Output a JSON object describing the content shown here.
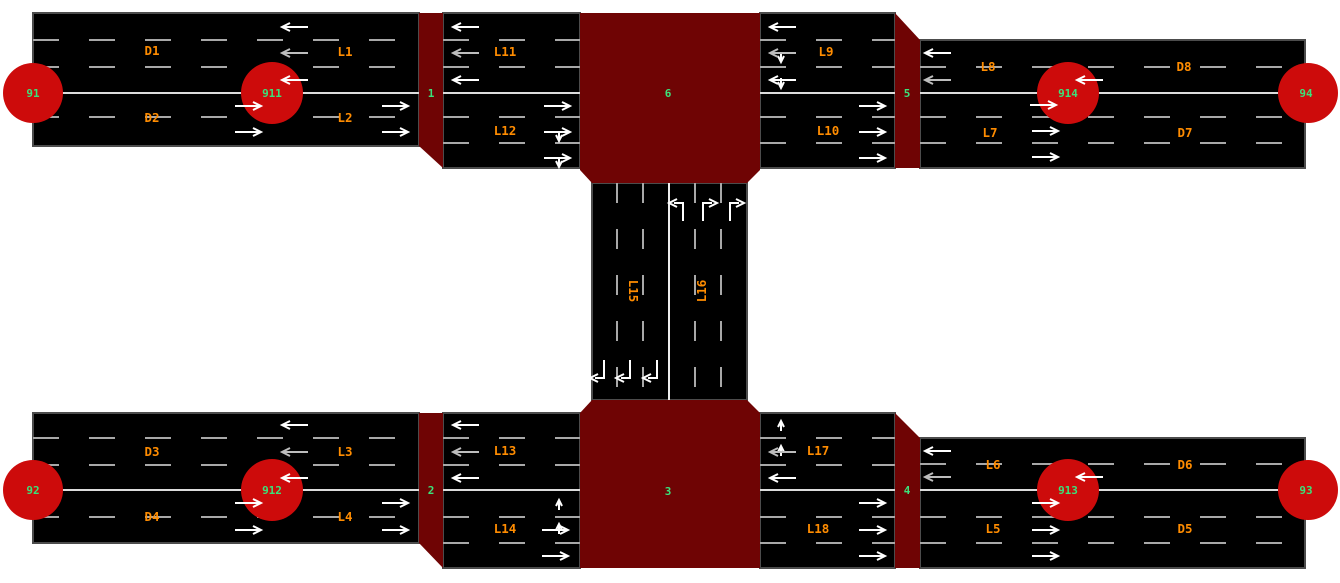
{
  "colors": {
    "background": "#ffffff",
    "road": "#000000",
    "junction_block": "#6f0404",
    "origin_node": "#cd0b0b",
    "node_label_green": "#3be27a",
    "lane_label_orange": "#ff8c00",
    "lane_marking_gray": "#a8a8a8",
    "center_line": "#dcdcdc",
    "arrow_white": "#ffffff"
  },
  "nodes": {
    "origins": {
      "n91": "91",
      "n911": "911",
      "n914": "914",
      "n94": "94",
      "n92": "92",
      "n912": "912",
      "n913": "913",
      "n93": "93"
    },
    "junctions": {
      "j1": "1",
      "j2": "2",
      "j3": "3",
      "j4": "4",
      "j5": "5",
      "j6": "6"
    }
  },
  "edges": {
    "d91_911": {
      "upper": "D1",
      "lower": "D2"
    },
    "l911_j1": {
      "upper": "L1",
      "lower": "L2"
    },
    "l_j1_j6": {
      "upper": "L11",
      "lower": "L12"
    },
    "l_j6_j5": {
      "upper": "L9",
      "lower": "L10"
    },
    "l_j5_914": {
      "upper": "L8",
      "lower": "L7"
    },
    "d914_94": {
      "upper": "D8",
      "lower": "D7"
    },
    "d92_912": {
      "upper": "D3",
      "lower": "D4"
    },
    "l912_j2": {
      "upper": "L3",
      "lower": "L4"
    },
    "l_j2_j3": {
      "upper": "L13",
      "lower": "L14"
    },
    "l_j3_j4": {
      "upper": "L17",
      "lower": "L18"
    },
    "l_j4_913": {
      "upper": "L6",
      "lower": "L5"
    },
    "d913_93": {
      "upper": "D6",
      "lower": "D5"
    },
    "v_j6_j3": {
      "left": "L15",
      "right": "L16"
    }
  }
}
